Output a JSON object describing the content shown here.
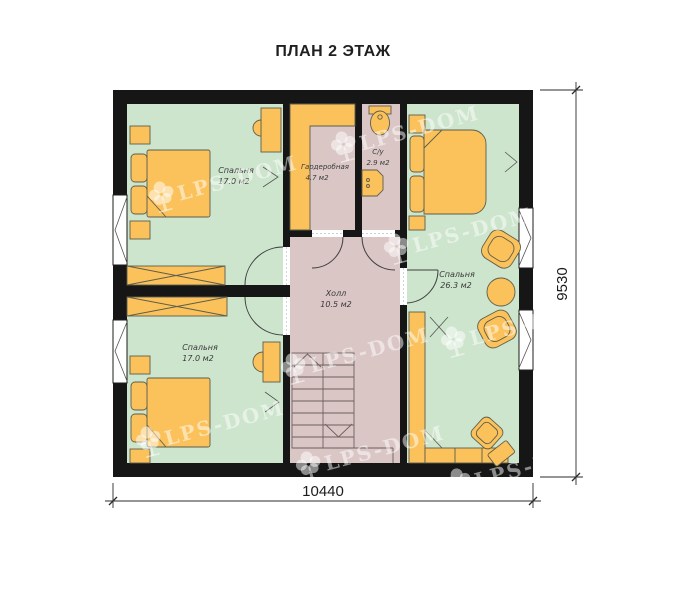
{
  "title": "ПЛАН 2 ЭТАЖ",
  "watermark": {
    "text": "LPS-DOM"
  },
  "dimensions": {
    "bottom": "10440",
    "right": "9530"
  },
  "rooms": {
    "bedroom_top_left": {
      "name": "Спальня",
      "area": "17.0 м2"
    },
    "bedroom_bottom_left": {
      "name": "Спальня",
      "area": "17.0 м2"
    },
    "bedroom_right": {
      "name": "Спальня",
      "area": "26.3 м2"
    },
    "wardrobe": {
      "name": "Гардеробная",
      "area": "4.7 м2"
    },
    "bathroom": {
      "name": "С/у",
      "area": "2.9 м2"
    },
    "hall": {
      "name": "Холл",
      "area": "10.5 м2"
    }
  },
  "colors": {
    "wall_color": "#161616",
    "room_green": "#cde4cd",
    "room_pink": "#d9c6c5",
    "furniture_fill": "#fbc25c",
    "furniture_stroke": "#5e5e4a"
  }
}
